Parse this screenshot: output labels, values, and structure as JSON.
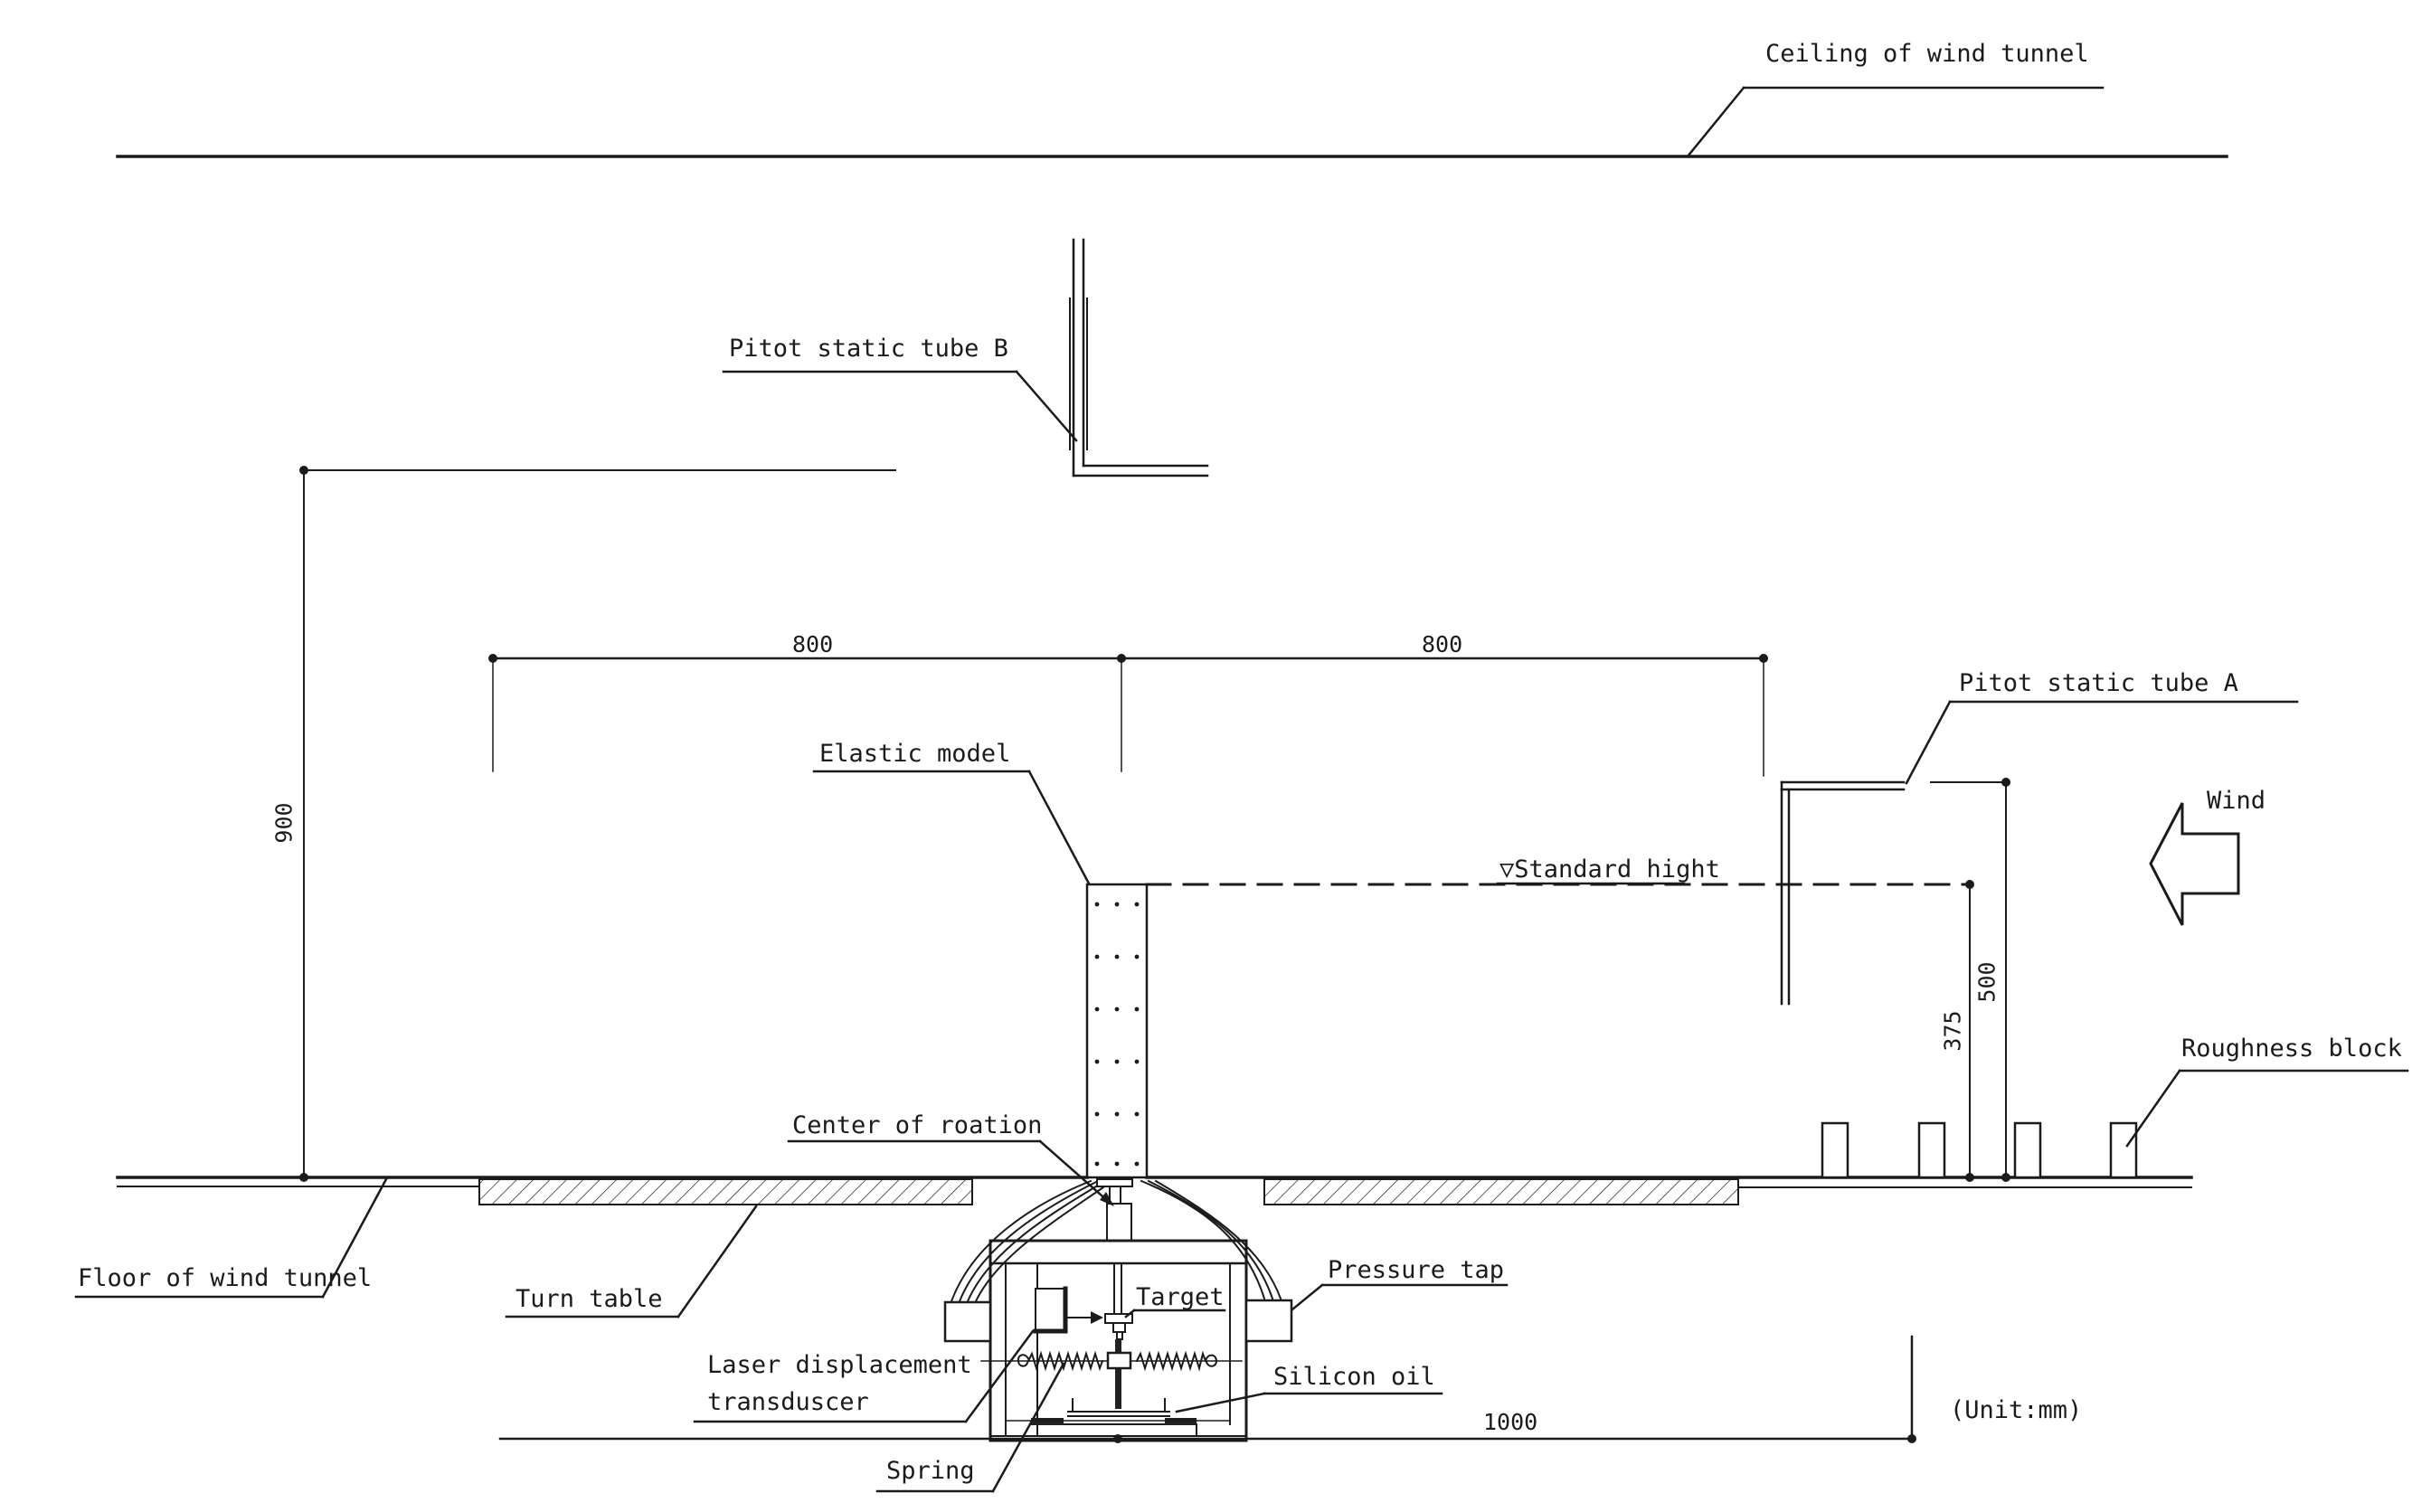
{
  "drawing": {
    "kind": "wind-tunnel aeroelastic test setup, sectional elevation",
    "unit_note": "(Unit:mm)",
    "line_color": "#1b1b1b"
  },
  "labels": {
    "ceiling": "Ceiling of wind tunnel",
    "floor": "Floor of wind tunnel",
    "pitot_b": "Pitot static tube B",
    "pitot_a": "Pitot static tube A",
    "wind": "Wind",
    "standard_height": "▽Standard hight",
    "roughness_block": "Roughness block",
    "elastic_model": "Elastic model",
    "center_of_rotation": "Center of roation",
    "turn_table": "Turn table",
    "laser_line1": "Laser displacement",
    "laser_line2": "transduscer",
    "target": "Target",
    "pressure_tap": "Pressure tap",
    "silicon_oil": "Silicon oil",
    "spring": "Spring"
  },
  "dimensions": {
    "span_left": "800",
    "span_right": "800",
    "height_left": "900",
    "height_pitot_a": "500",
    "height_standard": "375",
    "base_length": "1000"
  }
}
